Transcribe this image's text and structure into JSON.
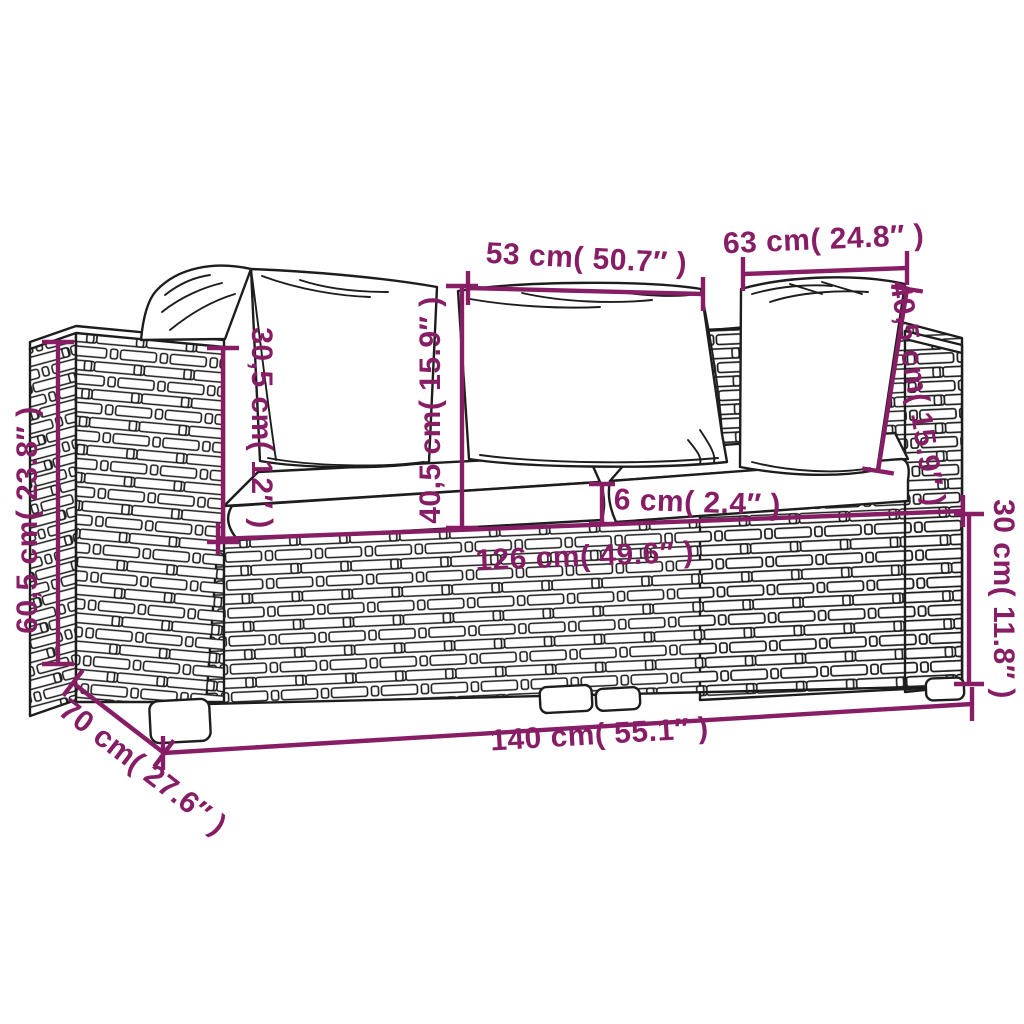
{
  "colors": {
    "dimension_purple": "#871e65",
    "sketch_line": "#1d1d1d",
    "background": "#ffffff"
  },
  "dims": [
    {
      "id": "center-pillow-width",
      "label": "53 cm( 50.7″ )"
    },
    {
      "id": "right-pillow-width",
      "label": "63 cm( 24.8″ )"
    },
    {
      "id": "total-height",
      "label": "60,5 cm( 23.8″ )"
    },
    {
      "id": "armrest-height",
      "label": "30,5 cm( 12″ )"
    },
    {
      "id": "pillow-height-center",
      "label": "40,5 cm( 15.9″ )"
    },
    {
      "id": "pillow-height-right",
      "label": "40,5 cm( 15.9″ )"
    },
    {
      "id": "cushion-thickness",
      "label": "6 cm( 2.4″ )"
    },
    {
      "id": "inner-width",
      "label": "126 cm( 49.6″ )"
    },
    {
      "id": "base-height",
      "label": "30 cm( 11.8″ )"
    },
    {
      "id": "total-width",
      "label": "140 cm( 55.1″ )"
    },
    {
      "id": "depth",
      "label": "70 cm( 27.6″ )"
    }
  ]
}
